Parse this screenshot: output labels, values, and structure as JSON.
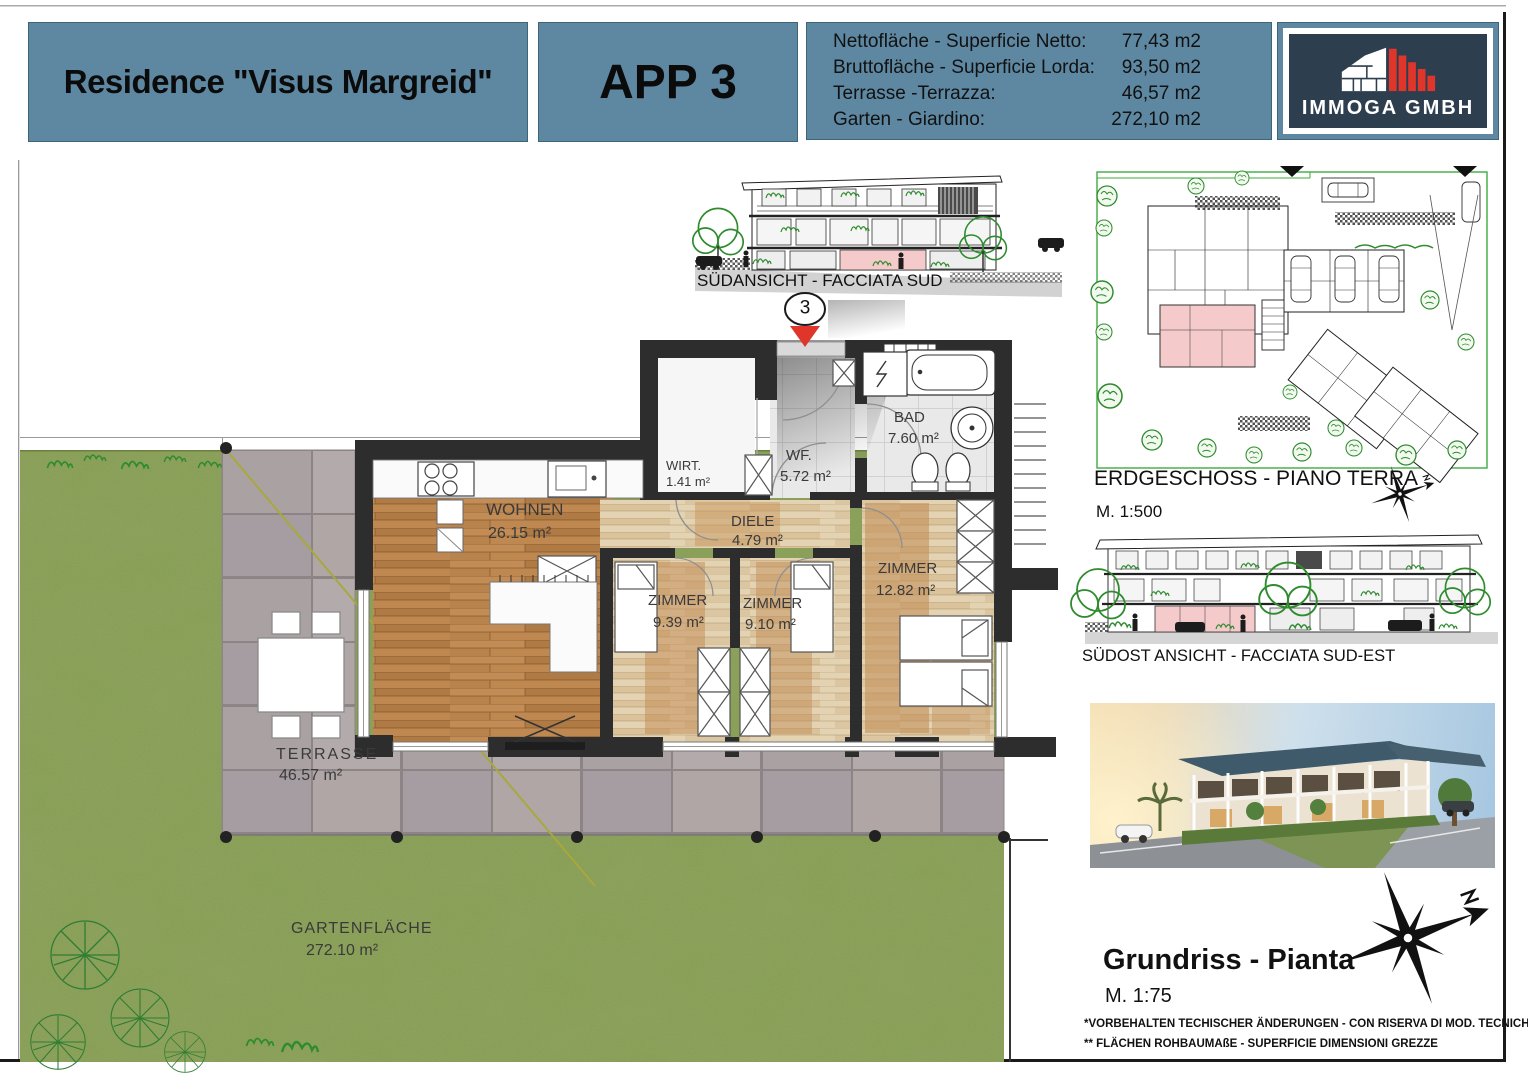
{
  "header": {
    "title": "Residence \"Visus Margreid\"",
    "apartment_label": "APP 3",
    "areas": [
      {
        "label": "Nettofläche - Superficie Netto:",
        "value": "77,43 m2"
      },
      {
        "label": "Bruttofläche - Superficie Lorda:",
        "value": "93,50 m2"
      },
      {
        "label": "Terrasse -Terrazza:",
        "value": "46,57 m2"
      },
      {
        "label": "Garten - Giardino:",
        "value": "272,10 m2"
      }
    ],
    "logo": {
      "company": "IMMOGA GMBH"
    }
  },
  "south_elevation": {
    "caption": "SÜDANSICHT - FACCIATA SUD"
  },
  "floor_plan": {
    "entrance_marker": "3",
    "rooms": {
      "wohnen": {
        "name": "WOHNEN",
        "area": "26.15 m²"
      },
      "wirt": {
        "name": "WIRT.",
        "area": "1.41 m²"
      },
      "wf": {
        "name": "WF.",
        "area": "5.72 m²"
      },
      "bad": {
        "name": "BAD",
        "area": "7.60 m²"
      },
      "diele": {
        "name": "DIELE",
        "area": "4.79 m²"
      },
      "zimmer1": {
        "name": "ZIMMER",
        "area": "9.39 m²"
      },
      "zimmer2": {
        "name": "ZIMMER",
        "area": "9.10 m²"
      },
      "zimmer3": {
        "name": "ZIMMER",
        "area": "12.82 m²"
      }
    },
    "outdoor": {
      "terrasse": {
        "name": "TERRASSE",
        "area": "46.57 m²"
      },
      "garten": {
        "name": "GARTENFLÄCHE",
        "area": "272.10 m²"
      }
    }
  },
  "site_plan": {
    "caption": "ERDGESCHOSS - PIANO TERRA",
    "scale": "M. 1:500"
  },
  "southeast_elevation": {
    "caption": "SÜDOST ANSICHT - FACCIATA SUD-EST"
  },
  "plan_footer": {
    "title": "Grundriss - Pianta",
    "scale": "M. 1:75",
    "disclaimer_line1": "*VORBEHALTEN TECHISCHER ÄNDERUNGEN - CON RISERVA DI MOD. TECNICHE",
    "disclaimer_line2": "** FLÄCHEN ROHBAUMAßE - SUPERFICIE DIMENSIONI GREZZE"
  },
  "colors": {
    "header_bg": "#5e88a2",
    "logo_bg": "#2d3e4f",
    "logo_red": "#e0352b",
    "highlight_pink": "#f5caca",
    "grass": "#90a35a",
    "wood": "#b9834d"
  }
}
